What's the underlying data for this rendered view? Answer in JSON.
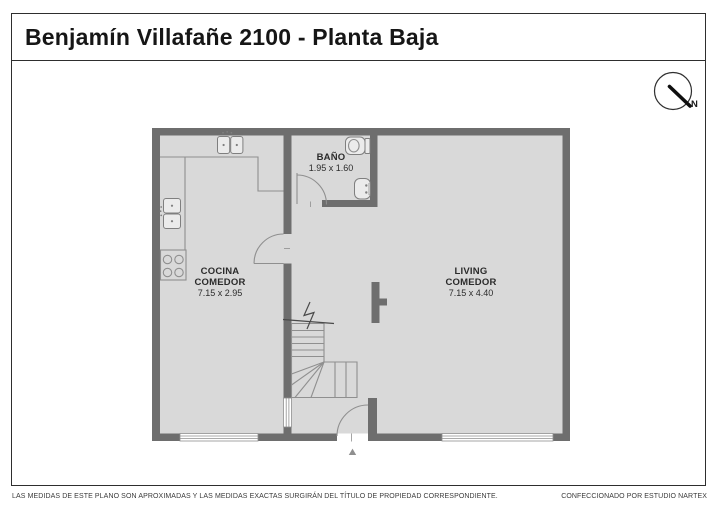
{
  "title": "Benjamín Villafañe 2100 - Planta Baja",
  "compass": {
    "label": "N"
  },
  "rooms": {
    "kitchen": {
      "line1": "COCINA",
      "line2": "COMEDOR",
      "dims": "7.15 x 2.95"
    },
    "living": {
      "line1": "LIVING",
      "line2": "COMEDOR",
      "dims": "7.15 x 4.40"
    },
    "bathroom": {
      "name": "BAÑO",
      "dims": "1.95 x 1.60"
    }
  },
  "footer": {
    "disclaimer": "LAS MEDIDAS  DE ESTE PLANO SON APROXIMADAS Y LAS MEDIDAS EXACTAS SURGIRÁN DEL TÍTULO DE PROPIEDAD CORRESPONDIENTE.",
    "credit": "CONFECCIONADO POR ESTUDIO NARTEX"
  },
  "colors": {
    "wall": "#6e6e6e",
    "floor": "#d9d9d9",
    "line": "#8f8f8f",
    "text": "#2b2b2b"
  }
}
